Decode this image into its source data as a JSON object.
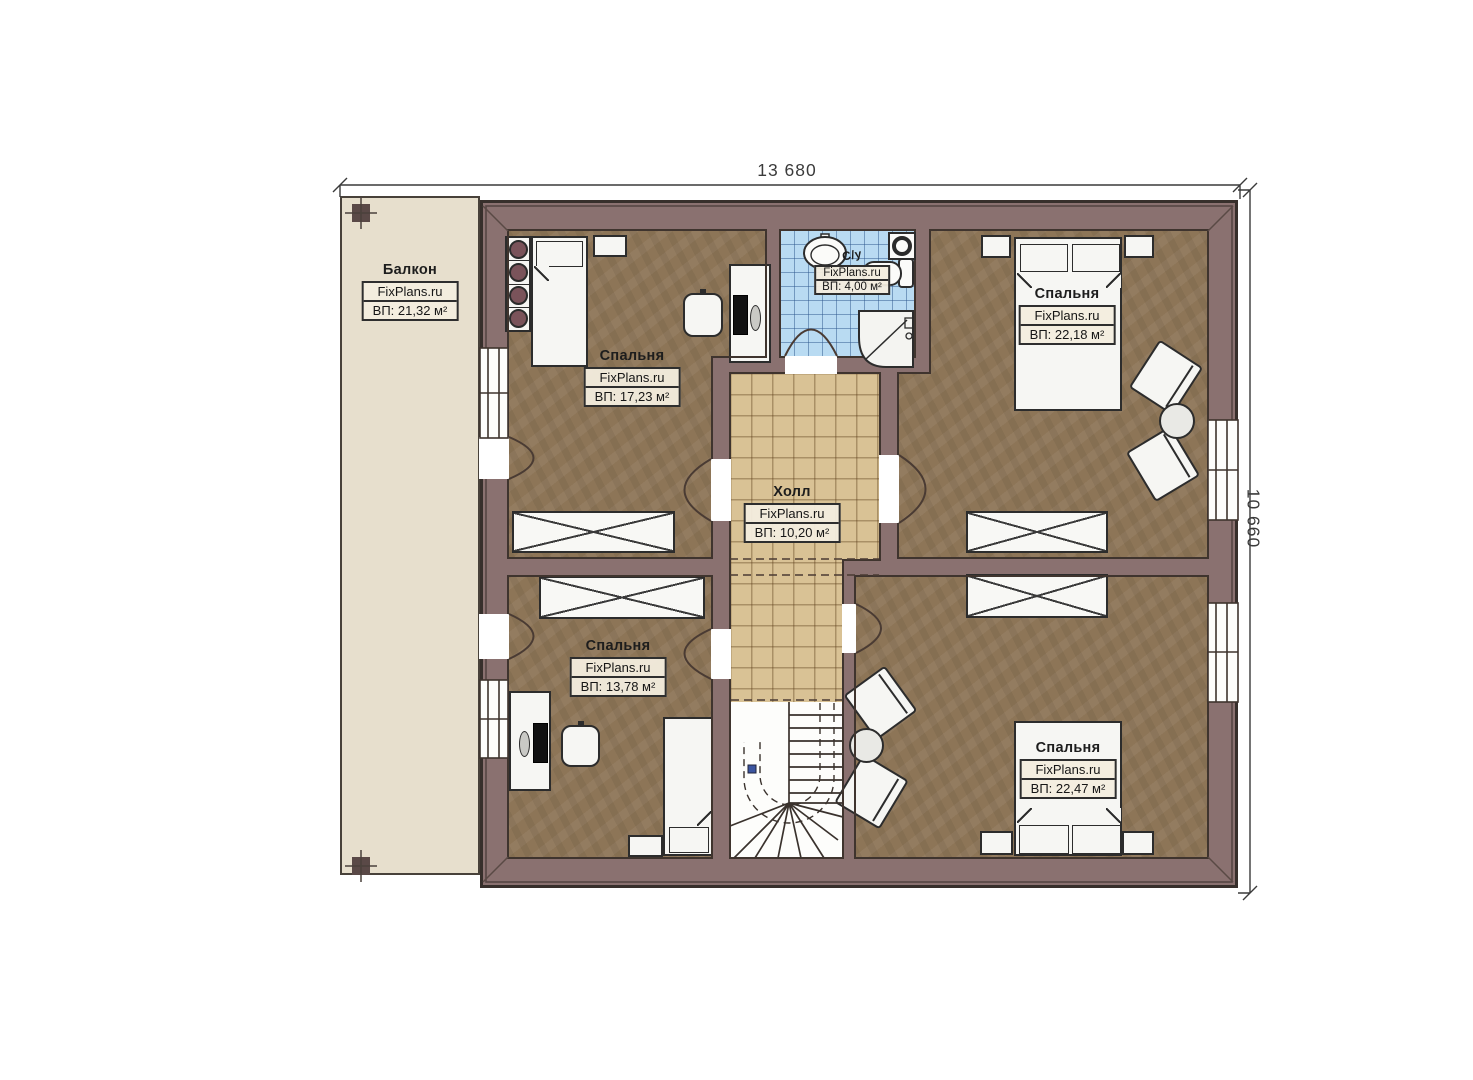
{
  "dimensions": {
    "width": "13 680",
    "height": "10 660"
  },
  "rooms": [
    {
      "name": "Балкон",
      "watermark": "FixPlans.ru",
      "area": "ВП: 21,32 м²"
    },
    {
      "name": "Спальня",
      "watermark": "FixPlans.ru",
      "area": "ВП: 17,23 м²"
    },
    {
      "name": "С/у",
      "watermark": "FixPlans.ru",
      "area": "ВП: 4,00 м²"
    },
    {
      "name": "Спальня",
      "watermark": "FixPlans.ru",
      "area": "ВП: 22,18 м²"
    },
    {
      "name": "Холл",
      "watermark": "FixPlans.ru",
      "area": "ВП: 10,20 м²"
    },
    {
      "name": "Спальня",
      "watermark": "FixPlans.ru",
      "area": "ВП: 13,78 м²"
    },
    {
      "name": "Спальня",
      "watermark": "FixPlans.ru",
      "area": "ВП: 22,47 м²"
    }
  ],
  "colors": {
    "wall": "#8a7170",
    "room_floor": "#8d7557",
    "hall_floor": "#d9c295",
    "bathroom_floor": "#b9dbf2",
    "balcony_floor": "#e7dfcd"
  }
}
